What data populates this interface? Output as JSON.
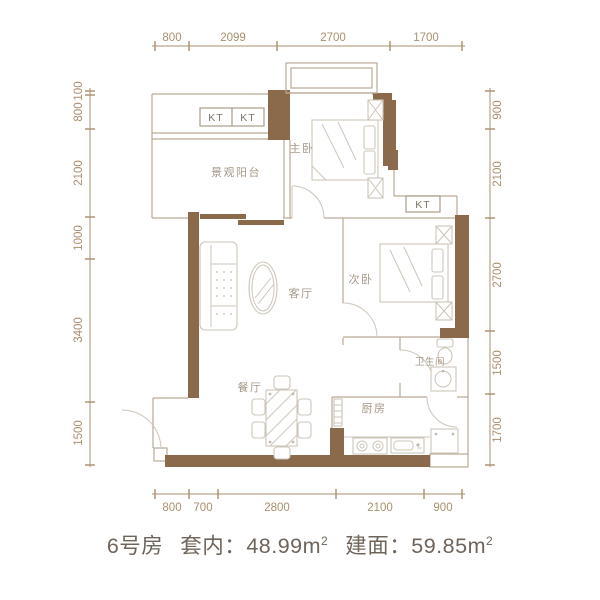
{
  "colors": {
    "wall": "#8a6a4a",
    "dimension": "#a98f6d",
    "thin_wall": "#b9a995",
    "furniture": "#cdc5b9",
    "room_label": "#a79889",
    "kt_label": "#7e7366",
    "title_text": "#6f6459"
  },
  "dimensions": {
    "top": [
      "800",
      "2099",
      "2700",
      "1700"
    ],
    "left": [
      "100",
      "800",
      "2100",
      "1000",
      "3400",
      "1500"
    ],
    "right": [
      "900",
      "2100",
      "2700",
      "1500",
      "1700"
    ],
    "bottom": [
      "800",
      "700",
      "2800",
      "2100",
      "900"
    ]
  },
  "rooms": {
    "balcony": "景观阳台",
    "master_bedroom": "主卧",
    "second_bedroom": "次卧",
    "living_room": "客厅",
    "dining_room": "餐厅",
    "kitchen": "厨房",
    "bathroom": "卫生间"
  },
  "ac_units": {
    "kt1": "KT",
    "kt2": "KT",
    "kt3": "KT"
  },
  "title": {
    "room_no": "6号房",
    "inner_label": "套内：",
    "inner_value": "48.99",
    "unit": "m",
    "sup": "2",
    "build_label": "建面：",
    "build_value": "59.85"
  }
}
